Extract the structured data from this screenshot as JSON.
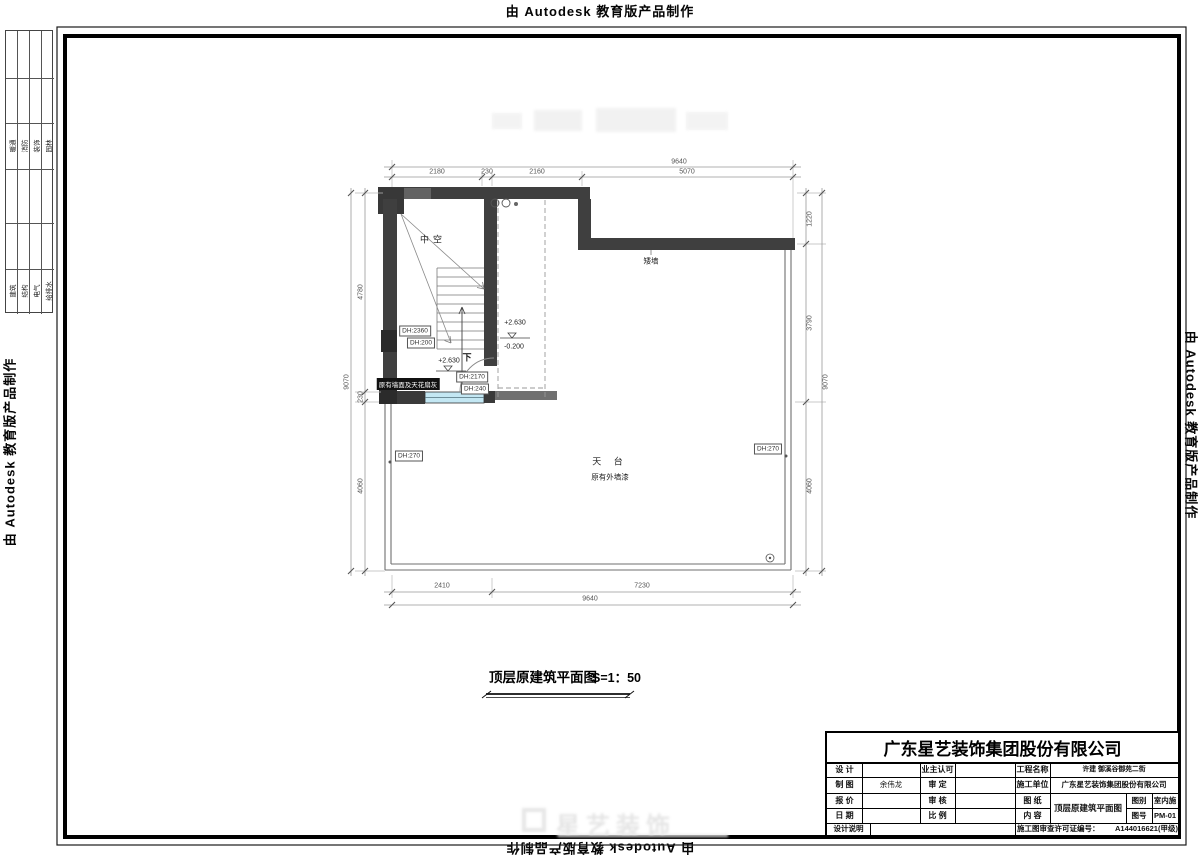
{
  "banner": {
    "text": "由 Autodesk 教育版产品制作"
  },
  "side_tables": {
    "group1": [
      "暖通",
      "消防",
      "装饰",
      "园林"
    ],
    "group2": [
      "建筑",
      "结构",
      "电气",
      "给排水"
    ]
  },
  "plan": {
    "title": "顶层原建筑平面图",
    "scale": "S=1：50",
    "labels": {
      "void": "中空",
      "terrace": "天 台",
      "terrace_note": "原有外墙漆",
      "wall_note": "原有墙面及天花扇灰",
      "low_wall": "矮墙",
      "down": "下",
      "level_up": "+2.630",
      "level_down": "-0.200",
      "dh_2360": "DH:2360",
      "dh_200": "DH:200",
      "dh_2170": "DH:2170",
      "dh_240": "DH:240",
      "dh_270": "DH:270"
    },
    "dims": {
      "top_overall": "9640",
      "top_segs": [
        "2180",
        "230",
        "2160",
        "5070"
      ],
      "left_segs": [
        "4780",
        "230",
        "4060"
      ],
      "left_overall": "9070",
      "right_segs": [
        "1220",
        "3790",
        "4060"
      ],
      "right_overall": "9070",
      "bottom_segs": [
        "2410",
        "7230"
      ],
      "bottom_overall": "9640"
    }
  },
  "watermark": {
    "brand": "星艺装饰"
  },
  "title_block": {
    "company": "广东星艺装饰集团股份有限公司",
    "design_label": "设 计",
    "draft_label": "制 图",
    "draft_value": "余伟龙",
    "quote_label": "报 价",
    "date_label": "日 期",
    "note_label": "设计说明",
    "owner_label": "业主认可",
    "approve_label": "审 定",
    "check_label": "审 核",
    "scale_label": "比 例",
    "project_label": "工程名称",
    "project_value": "许建 御溪谷御苑二街",
    "builder_label": "施工单位",
    "builder_value": "广东星艺装饰集团股份有限公司",
    "sheet_label": "图 纸",
    "content_label": "内 容",
    "sheet_value": "顶层原建筑平面图",
    "cat_label": "图别",
    "cat_value": "室内施",
    "no_label": "图号",
    "no_value": "PM-01",
    "license_label": "施工图审查许可证编号：",
    "license_value": "A144016621(甲级)"
  }
}
